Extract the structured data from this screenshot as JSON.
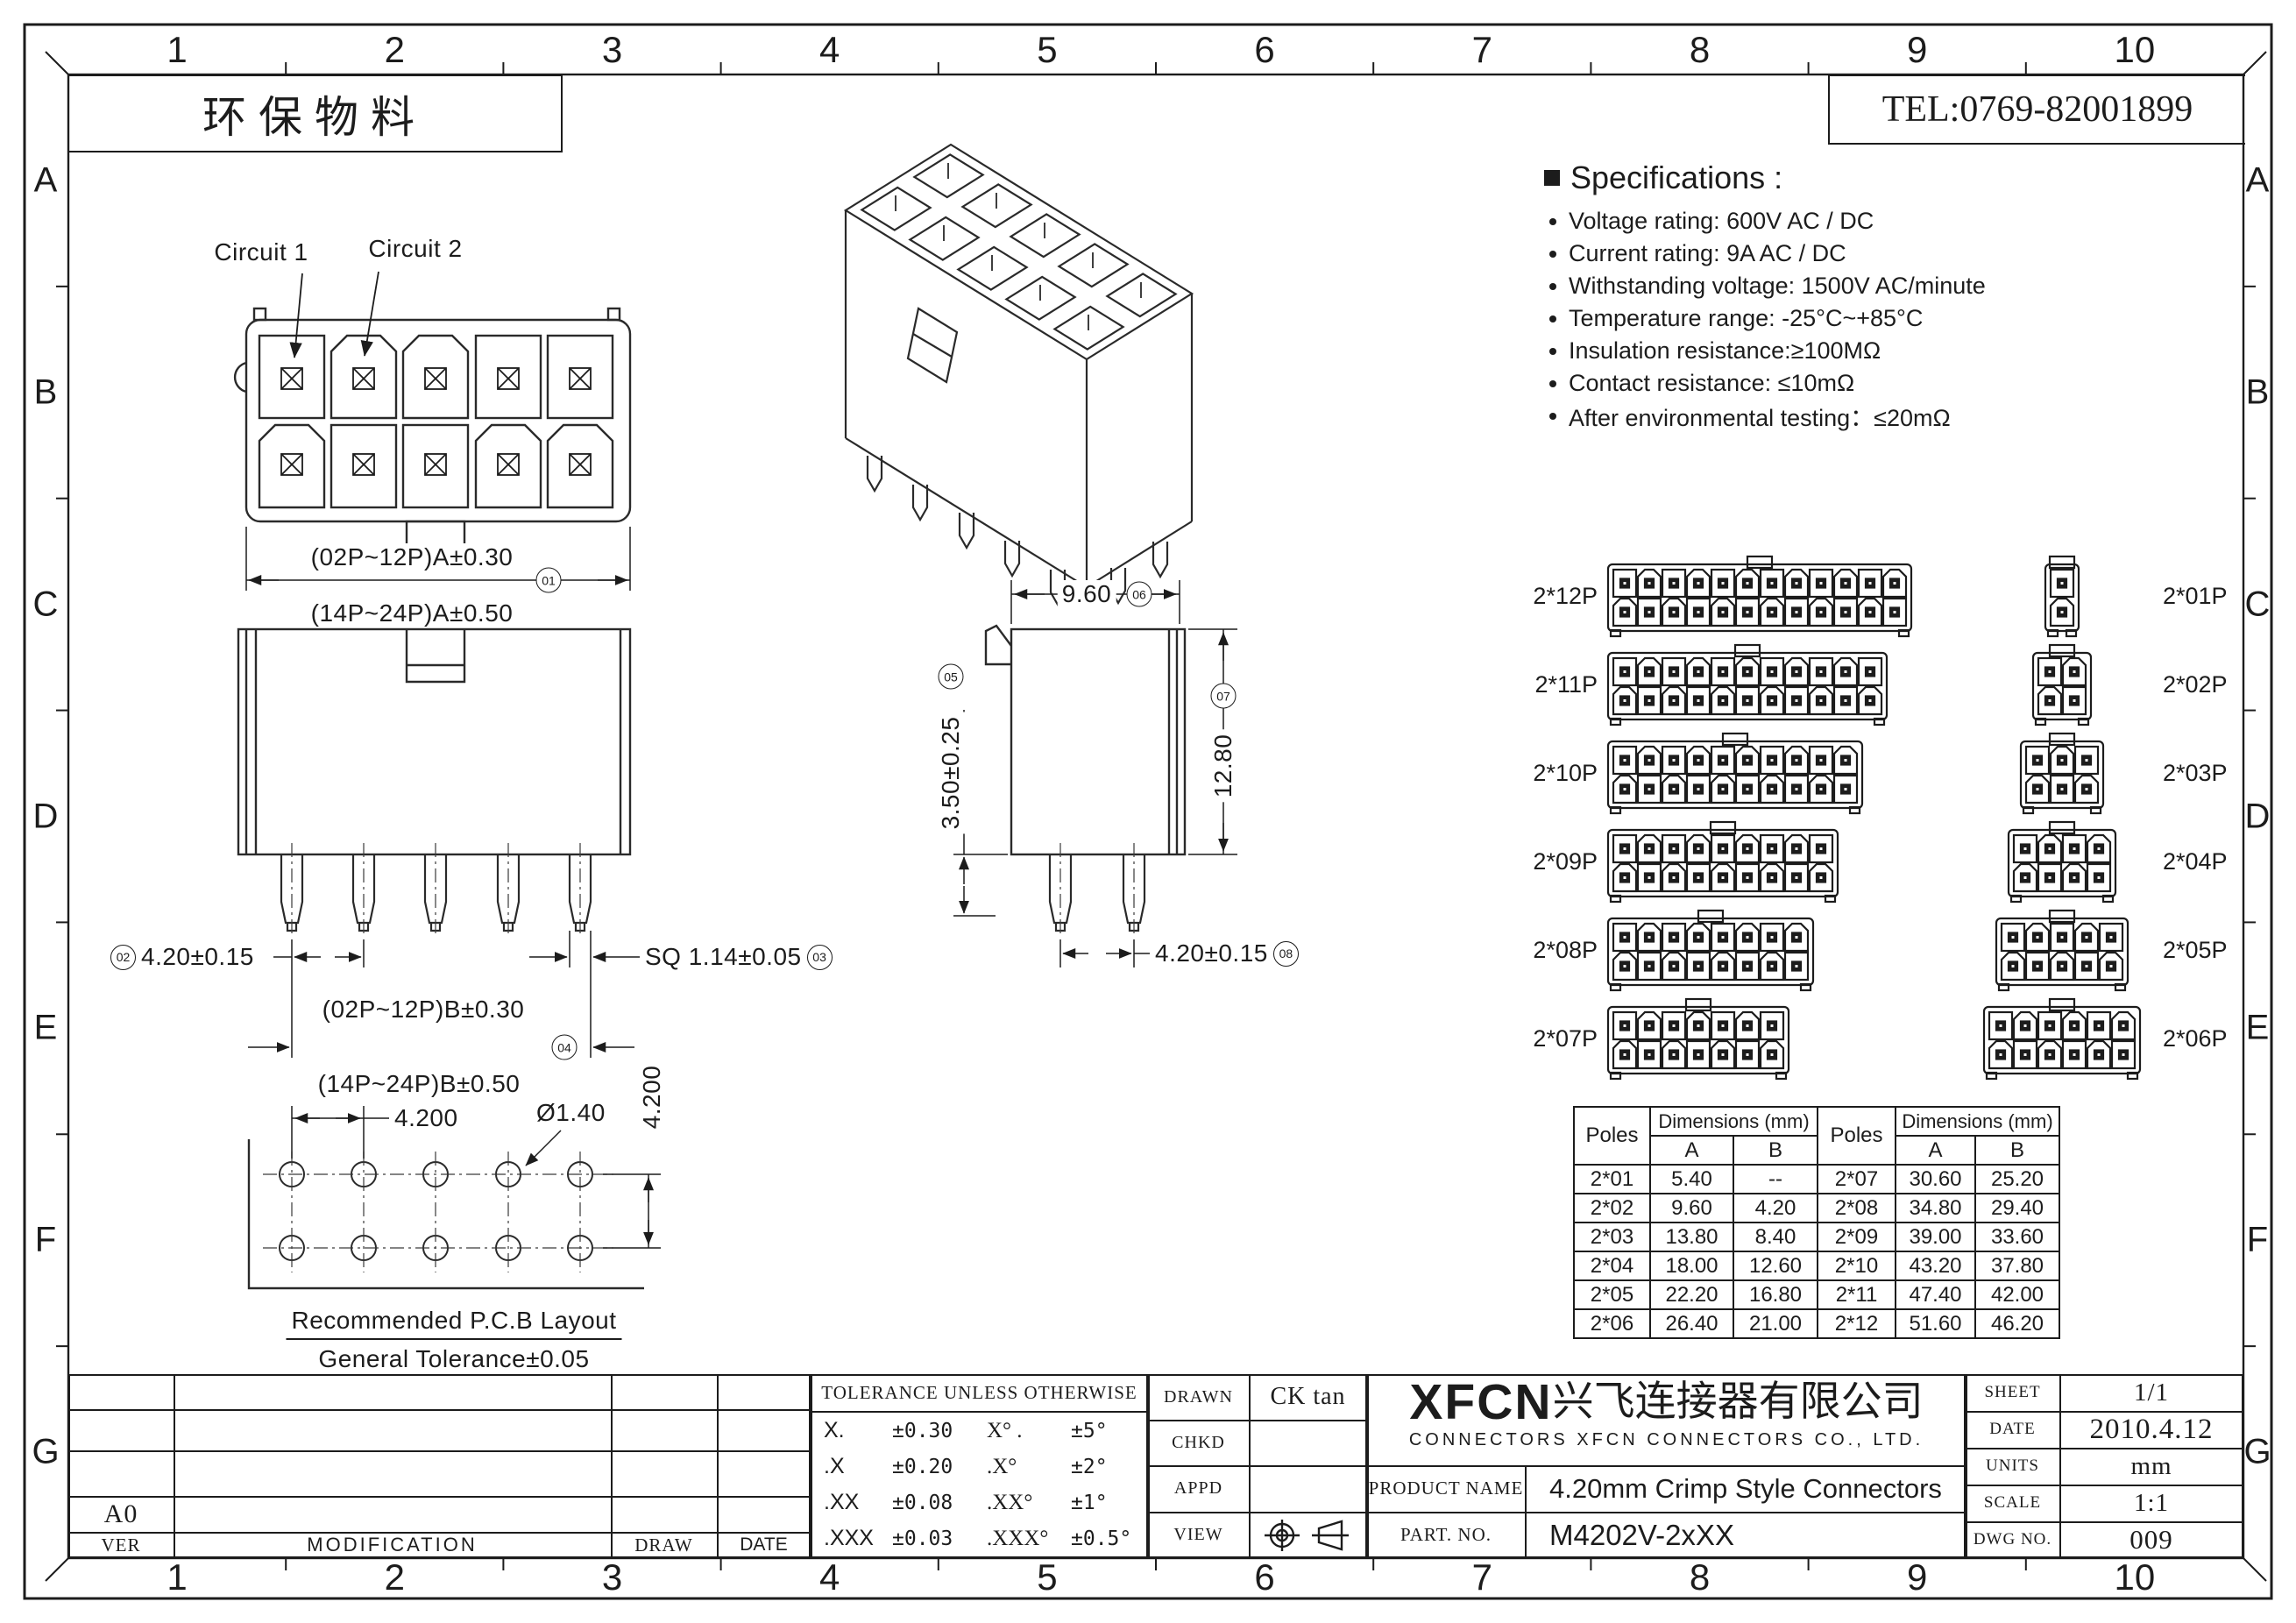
{
  "header": {
    "eco_label": "环保物料",
    "tel": "TEL:0769-82001899"
  },
  "grid": {
    "cols": [
      "1",
      "2",
      "3",
      "4",
      "5",
      "6",
      "7",
      "8",
      "9",
      "10"
    ],
    "rows": [
      "A",
      "B",
      "C",
      "D",
      "E",
      "F",
      "G"
    ]
  },
  "specifications": {
    "title": "Specifications :",
    "items": [
      "Voltage rating: 600V AC / DC",
      "Current rating: 9A  AC / DC",
      "Withstanding voltage: 1500V AC/minute",
      "Temperature range: -25°C~+85°C",
      "Insulation resistance:≥100MΩ",
      "Contact resistance: ≤10mΩ",
      "After environmental testing：≤20mΩ"
    ]
  },
  "views": {
    "circuit1": "Circuit 1",
    "circuit2": "Circuit 2",
    "dims": {
      "a": {
        "l1": "(02P~12P)A±0.30",
        "l2": "(14P~24P)A±0.50",
        "balloon": "01"
      },
      "pitch_front": {
        "text": "4.20±0.15",
        "balloon": "02"
      },
      "sq": {
        "text": "SQ 1.14±0.05",
        "balloon": "03"
      },
      "b": {
        "l1": "(02P~12P)B±0.30",
        "l2": "(14P~24P)B±0.50",
        "balloon": "04"
      },
      "standoff": {
        "text": "3.50±0.25",
        "balloon": "05"
      },
      "width": {
        "text": "9.60",
        "balloon": "06"
      },
      "height": {
        "text": "12.80",
        "balloon": "07"
      },
      "pitch_side": {
        "text": "4.20±0.15",
        "balloon": "08"
      }
    },
    "pcb": {
      "pitch_h": "4.200",
      "hole": "Ø1.40",
      "pitch_v": "4.200",
      "caption1": "Recommended P.C.B Layout",
      "caption2": "General Tolerance±0.05"
    }
  },
  "connectors": {
    "left": [
      {
        "label": "2*12P",
        "cols": 12
      },
      {
        "label": "2*11P",
        "cols": 11
      },
      {
        "label": "2*10P",
        "cols": 10
      },
      {
        "label": "2*09P",
        "cols": 9
      },
      {
        "label": "2*08P",
        "cols": 8
      },
      {
        "label": "2*07P",
        "cols": 7
      }
    ],
    "right": [
      {
        "label": "2*01P",
        "cols": 1
      },
      {
        "label": "2*02P",
        "cols": 2
      },
      {
        "label": "2*03P",
        "cols": 3
      },
      {
        "label": "2*04P",
        "cols": 4
      },
      {
        "label": "2*05P",
        "cols": 5
      },
      {
        "label": "2*06P",
        "cols": 6
      }
    ]
  },
  "poles_table": {
    "header": {
      "poles": "Poles",
      "dims": "Dimensions (mm)",
      "a": "A",
      "b": "B"
    },
    "rows": [
      [
        "2*01",
        "5.40",
        "--",
        "2*07",
        "30.60",
        "25.20"
      ],
      [
        "2*02",
        "9.60",
        "4.20",
        "2*08",
        "34.80",
        "29.40"
      ],
      [
        "2*03",
        "13.80",
        "8.40",
        "2*09",
        "39.00",
        "33.60"
      ],
      [
        "2*04",
        "18.00",
        "12.60",
        "2*10",
        "43.20",
        "37.80"
      ],
      [
        "2*05",
        "22.20",
        "16.80",
        "2*11",
        "47.40",
        "42.00"
      ],
      [
        "2*06",
        "26.40",
        "21.00",
        "2*12",
        "51.60",
        "46.20"
      ]
    ]
  },
  "title_block": {
    "revision": {
      "ver_value": "A0",
      "ver": "VER",
      "modification": "MODIFICATION",
      "draw": "DRAW",
      "date": "DATE"
    },
    "tolerance": {
      "title": "TOLERANCE UNLESS OTHERWISE",
      "rows": [
        [
          "X.",
          "±0.30",
          "X° .",
          "±5°"
        ],
        [
          ".X",
          "±0.20",
          ".X°",
          "±2°"
        ],
        [
          ".XX",
          "±0.08",
          ".XX°",
          "±1°"
        ],
        [
          ".XXX",
          "±0.03",
          ".XXX°",
          "±0.5°"
        ]
      ]
    },
    "approval": {
      "drawn": "DRAWN",
      "drawn_value": "CK tan",
      "chkd": "CHKD",
      "appd": "APPD",
      "view": "VIEW"
    },
    "company": {
      "logo": "XFCN",
      "name_cn": "兴飞连接器有限公司",
      "name_en": "CONNECTORS XFCN CONNECTORS CO., LTD.",
      "product_label": "PRODUCT NAME",
      "product_value": "4.20mm Crimp Style Connectors",
      "part_label": "PART. NO.",
      "part_value": "M4202V-2xXX"
    },
    "info": {
      "sheet_label": "SHEET",
      "sheet_value": "1/1",
      "date_label": "DATE",
      "date_value": "2010.4.12",
      "units_label": "UNITS",
      "units_value": "mm",
      "scale_label": "SCALE",
      "scale_value": "1:1",
      "dwg_label": "DWG NO.",
      "dwg_value": "009"
    }
  }
}
